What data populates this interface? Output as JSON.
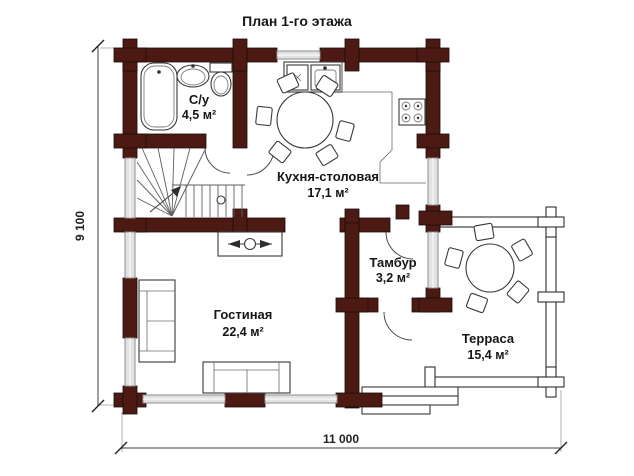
{
  "title": "План 1-го этажа",
  "dimensions": {
    "width": "11 000",
    "height": "9 100"
  },
  "rooms": {
    "bathroom": {
      "name": "С/у",
      "area": "4,5 м²"
    },
    "kitchen_dining": {
      "name": "Кухня-столовая",
      "area": "17,1 м²"
    },
    "living_room": {
      "name": "Гостиная",
      "area": "22,4 м²"
    },
    "vestibule": {
      "name": "Тамбур",
      "area": "3,2 м²"
    },
    "terrace": {
      "name": "Терраса",
      "area": "15,4 м²"
    }
  },
  "colors": {
    "log_wall": "#4c1a13",
    "window_glass": "#e2e2e2",
    "line": "#3c3c3c",
    "text": "#161616",
    "background": "#ffffff"
  }
}
